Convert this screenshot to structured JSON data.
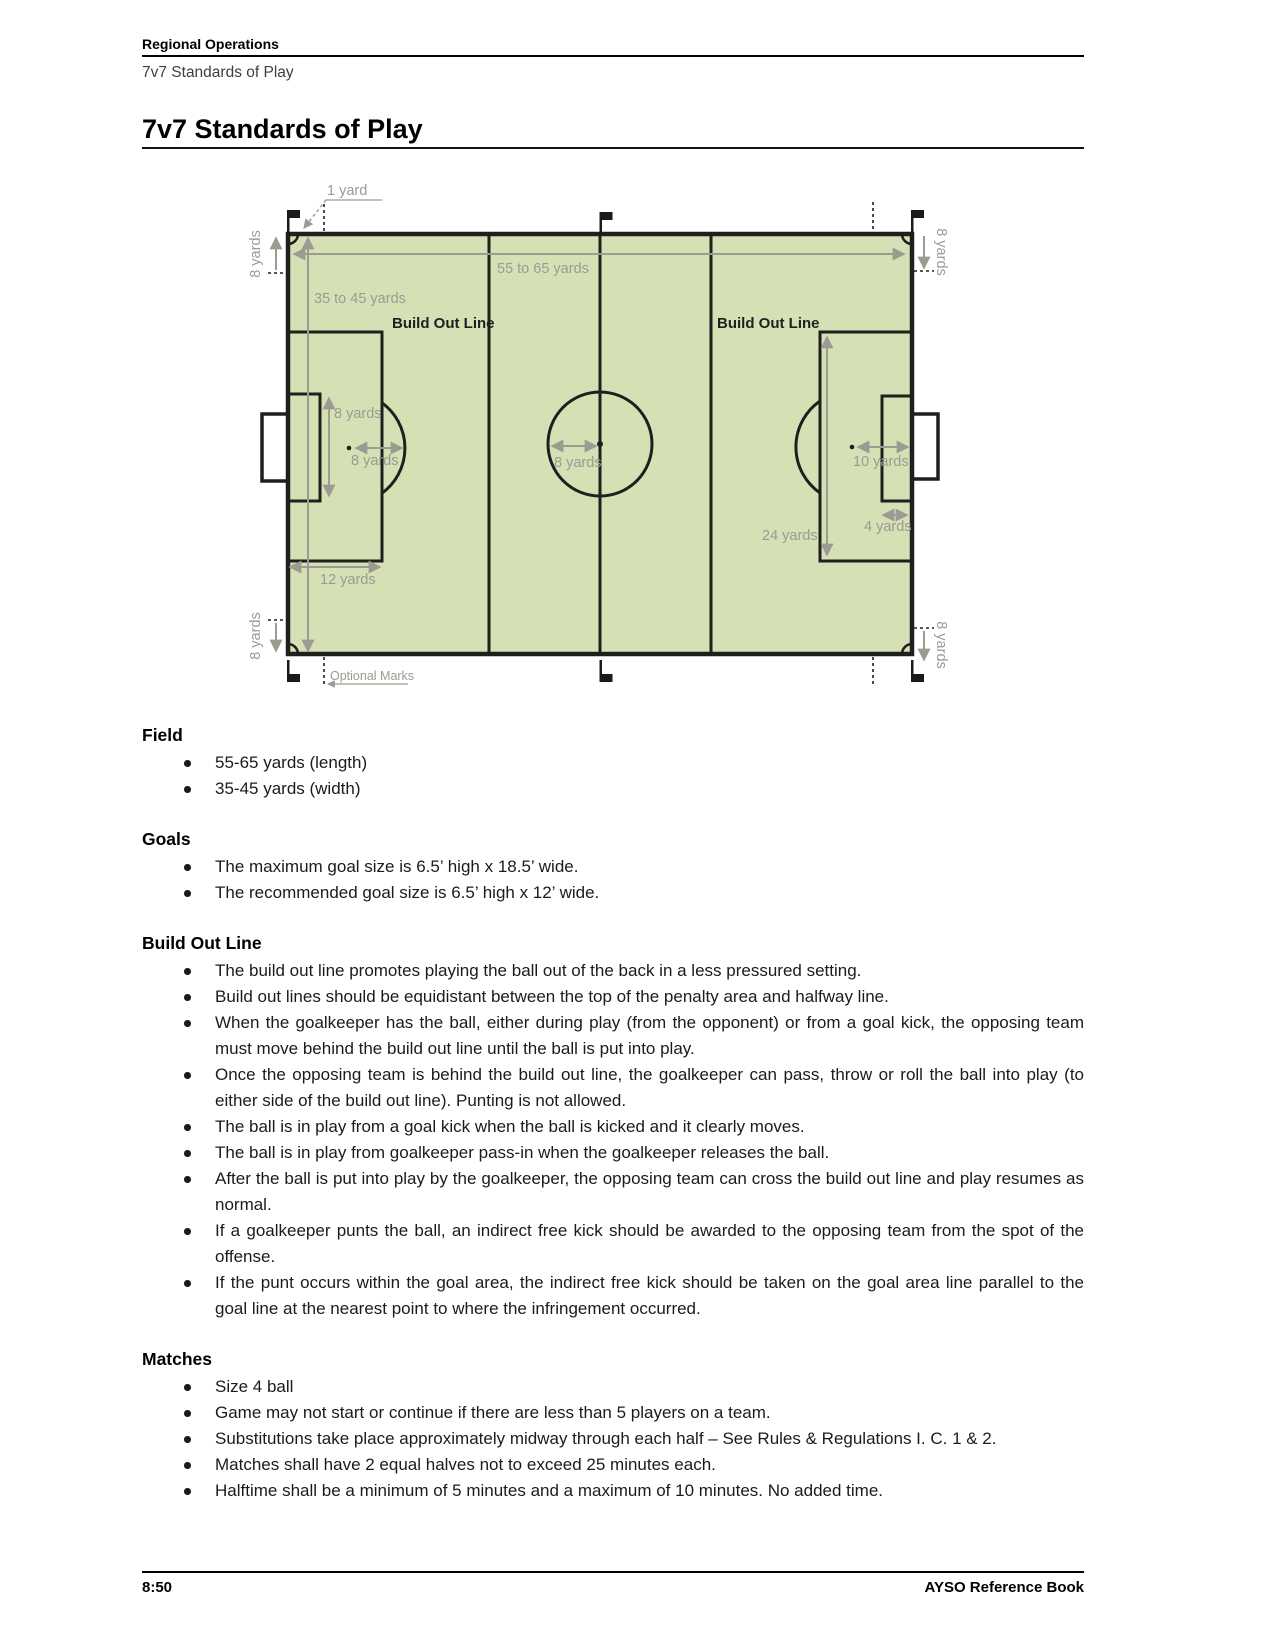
{
  "header": {
    "section": "Regional Operations",
    "subtitle": "7v7 Standards of Play"
  },
  "title": "7v7 Standards of Play",
  "diagram": {
    "field_fill": "#d5e1b5",
    "line_color": "#1f1f1f",
    "annotation_color": "#9b9b92",
    "labels": {
      "one_yard": "1 yard",
      "length": "55 to 65 yards",
      "width": "35 to 45 yards",
      "build_out_line": "Build Out Line",
      "goal_area_height": "8 yards",
      "penalty_spot_distance": "8 yards",
      "center_circle_radius": "8 yards",
      "corner_mark": "8 yards",
      "penalty_area_width": "12 yards",
      "penalty_area_height": "24 yards",
      "penalty_spot_distance_right": "10 yards",
      "goal_area_depth": "4 yards",
      "optional_marks": "Optional Marks"
    }
  },
  "sections": [
    {
      "heading": "Field",
      "bullets": [
        "55-65 yards (length)",
        "35-45 yards (width)"
      ]
    },
    {
      "heading": "Goals",
      "bullets": [
        "The maximum goal size is 6.5’ high x 18.5’ wide.",
        "The recommended goal size is 6.5’ high x 12’ wide."
      ]
    },
    {
      "heading": "Build Out Line",
      "bullets": [
        "The build out line promotes playing the ball out of the back in a less pressured setting.",
        "Build out lines should be equidistant between the top of the penalty area and halfway line.",
        "When the goalkeeper has the ball, either during play (from the opponent) or from a goal kick, the opposing team must move behind the build out line until the ball is put into play.",
        "Once the opposing team is behind the build out line, the goalkeeper can pass, throw or roll the ball into play (to either side of the build out line). Punting is not allowed.",
        "The ball is in play from a goal kick when the ball is kicked and it clearly moves.",
        "The ball is in play from goalkeeper pass-in when the goalkeeper releases the ball.",
        "After the ball is put into play by the goalkeeper, the opposing team can cross the build out line and play resumes as normal.",
        "If a goalkeeper punts the ball, an indirect free kick should be awarded to the opposing team from the spot of the offense.",
        "If the punt occurs within the goal area, the indirect free kick should be taken on the goal area line parallel to the goal line at the nearest point to where the infringement occurred."
      ]
    },
    {
      "heading": "Matches",
      "bullets": [
        "Size 4 ball",
        "Game may not start or continue if there are less than 5 players on a team.",
        "Substitutions take place approximately midway through each half – See Rules & Regulations I. C. 1 & 2.",
        "Matches shall have 2 equal halves not to exceed 25 minutes each.",
        "Halftime shall be a minimum of 5 minutes and a maximum of 10 minutes. No added time."
      ]
    }
  ],
  "footer": {
    "page_number": "8:50",
    "book_title": "AYSO Reference Book"
  }
}
